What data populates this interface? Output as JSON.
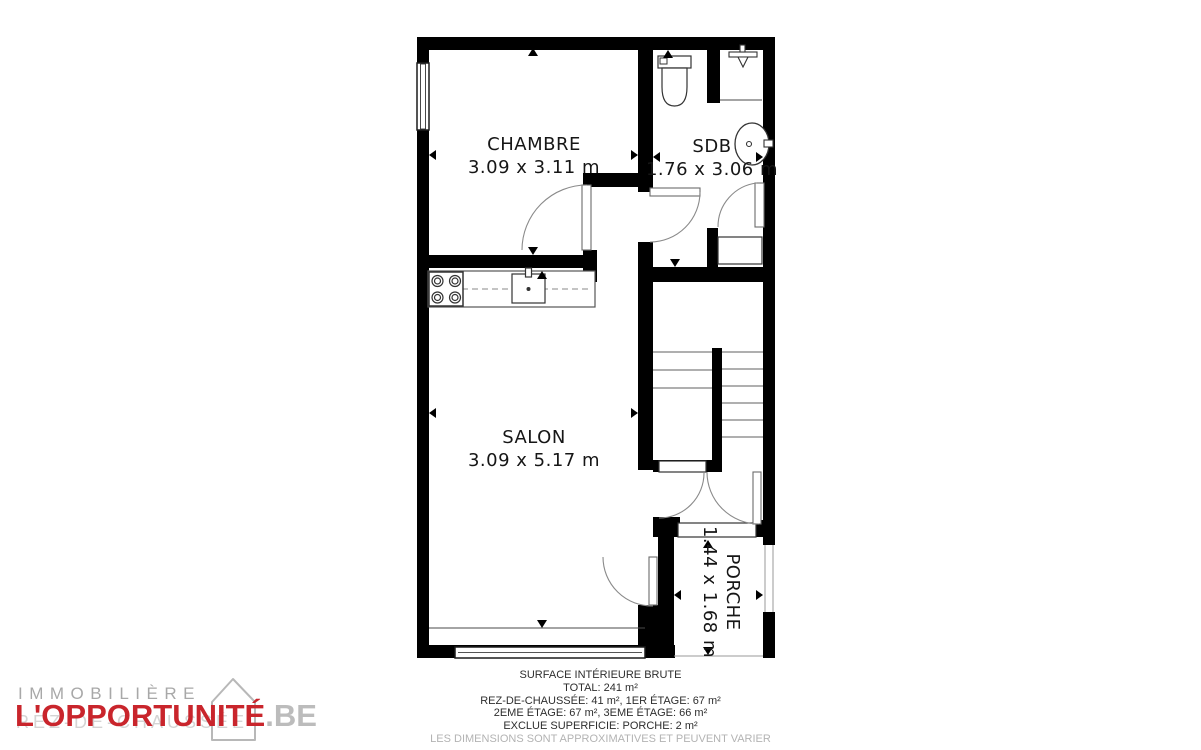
{
  "plan": {
    "rooms": [
      {
        "name": "CHAMBRE",
        "dims": "3.09 x 3.11 m"
      },
      {
        "name": "SDB",
        "dims": "1.76 x 3.06 m"
      },
      {
        "name": "SALON",
        "dims": "3.09 x 5.17 m"
      },
      {
        "name": "PORCHE",
        "dims": "1.44 x 1.68 m"
      }
    ]
  },
  "footer": {
    "line1": "SURFACE INTÉRIEURE BRUTE",
    "line2": "TOTAL: 241 m²",
    "line3": "REZ-DE-CHAUSSÉE: 41 m², 1ER ÉTAGE: 67 m²",
    "line4": "2EME ÉTAGE: 67 m², 3EME ÉTAGE: 66 m²",
    "line5": "EXCLUE SUPERFICIE: PORCHE: 2 m²",
    "disclaimer": "LES DIMENSIONS SONT APPROXIMATIVES ET PEUVENT VARIER"
  },
  "logo": {
    "top": "IMMOBILIÈRE",
    "brand": "L'OPPORTUNITÉ",
    "tld": ".BE",
    "watermark": "REZ-DE-CHAUSSÉE"
  },
  "colors": {
    "wall": "#000000",
    "brand_red": "#c9252c",
    "logo_gray": "#b8b8b8",
    "disclaimer_gray": "#b3b3b3"
  }
}
